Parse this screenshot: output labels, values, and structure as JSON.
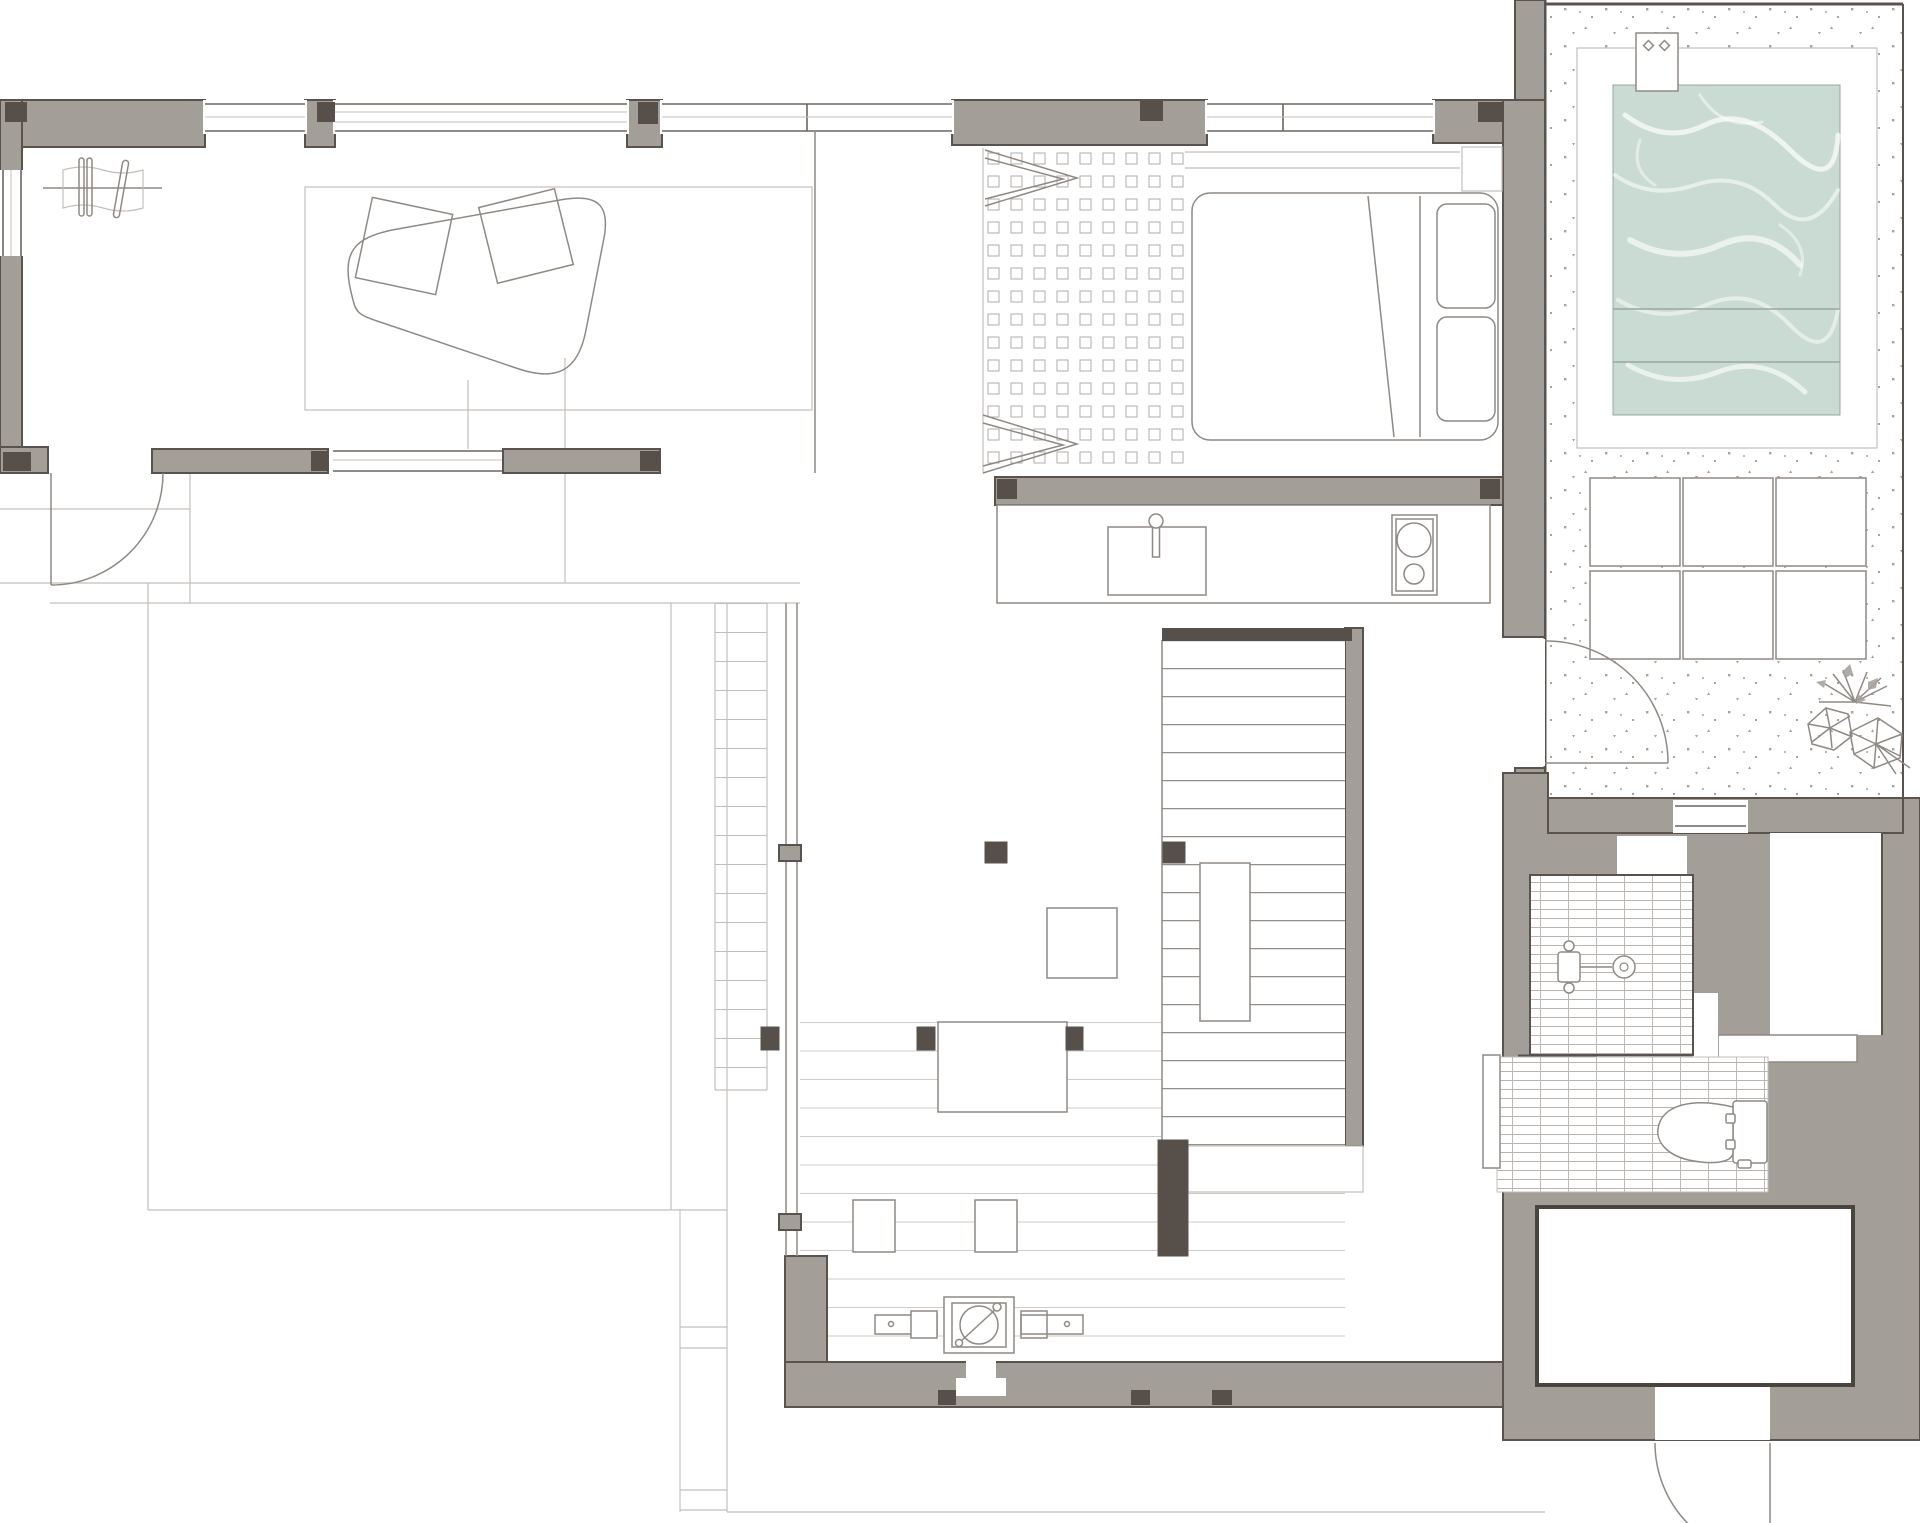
{
  "document": {
    "type": "architectural floor plan (top view), single storey house with pool",
    "visible_text": []
  },
  "canvas": {
    "width_px": 1920,
    "height_px": 1523
  },
  "theme": {
    "bg": "#ffffff",
    "wall": "#a49e99",
    "wallline": "#5a534d",
    "pier": "#57504a",
    "winline": "#6b655f",
    "furn": "#8f8983",
    "light": "#c3beb9",
    "tile": "#b8b3ae",
    "dot": "#b2ada8",
    "plank": "#cfcbc6",
    "tread": "#948e88",
    "stip": "#a8a29c",
    "water": "#cadbd4",
    "wave": "#ffffff",
    "poolline": "#97a7a1",
    "storage": "#4a443f"
  },
  "rooms": [
    "lounge",
    "entry-hall",
    "bedroom",
    "walk-in-closet",
    "kitchen",
    "living-dining-area",
    "staircase",
    "corridor",
    "shower-room",
    "toilet-area",
    "storage-room",
    "pool-terrace",
    "outdoor-deck",
    "side-yard"
  ],
  "furniture_and_fixtures": [
    "plant-console",
    "area-rug",
    "floor-cushions",
    "organic-lounge-chair",
    "double-bed",
    "pillows",
    "headboard-shelf",
    "nightstand",
    "wardrobe-rail-chevrons",
    "dot-grid-closet-floor",
    "kitchen-counter",
    "kitchen-sink",
    "faucet",
    "two-burner-cooktop",
    "deck-table",
    "low-square-table",
    "seat-cushions",
    "wood-stove",
    "stair-treads",
    "stair-landing",
    "columns",
    "shower-mixer",
    "rain-shower-head",
    "toilet",
    "duckboard-mat",
    "bath-bench",
    "wall-niches",
    "swimming-pool",
    "pool-steps",
    "pool-skimmer",
    "stone-pavers",
    "palm-plant",
    "speckled-terrace-paving",
    "swing-door-entry",
    "swing-door-terrace",
    "swing-door-rear",
    "fixed-windows"
  ]
}
